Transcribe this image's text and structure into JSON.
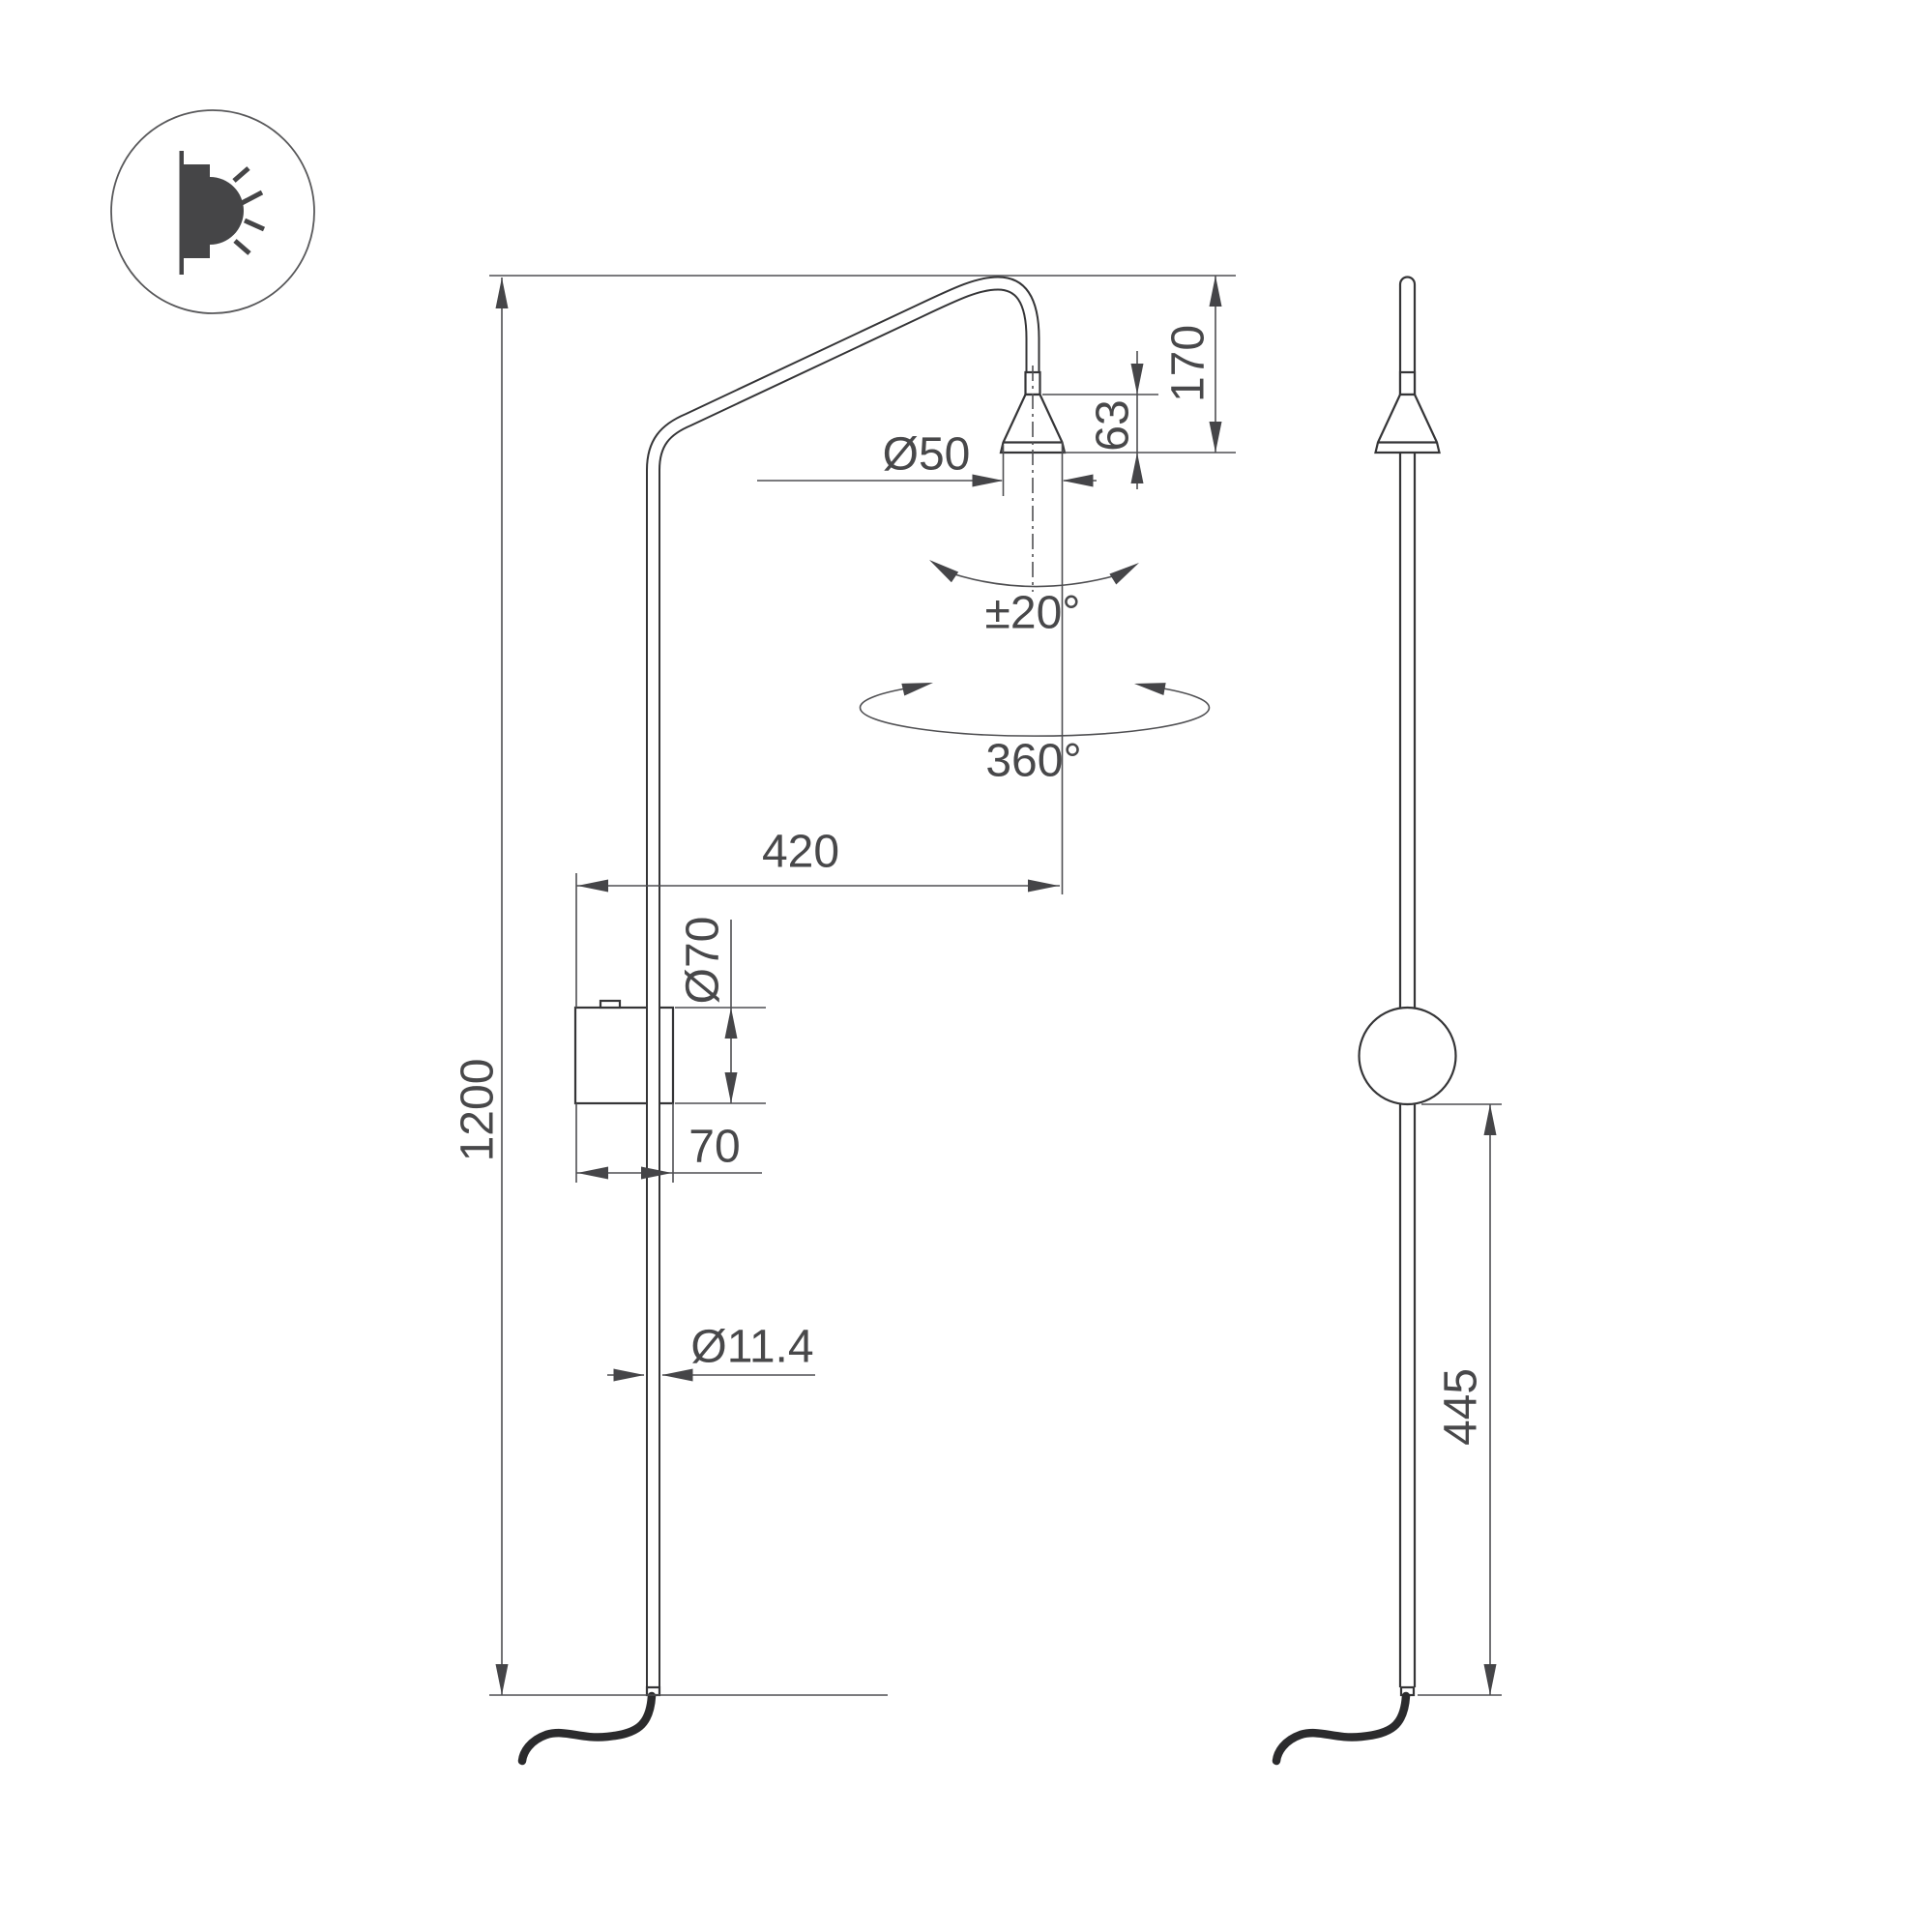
{
  "icon": {
    "name": "wall-light-indicator"
  },
  "colors": {
    "line": "#353537",
    "dimension": "#4f4f52",
    "text": "#48484a",
    "cable": "#2b2b2d",
    "background": "#ffffff"
  },
  "dimensions": {
    "total_height": "1200",
    "arm_reach": "420",
    "head_diameter": "Ø50",
    "head_cone_height": "63",
    "head_drop": "170",
    "tilt_range": "±20°",
    "rotation_range": "360°",
    "box_diameter": "Ø70",
    "box_depth": "70",
    "tube_diameter": "Ø11.4",
    "sphere_to_base": "445"
  }
}
